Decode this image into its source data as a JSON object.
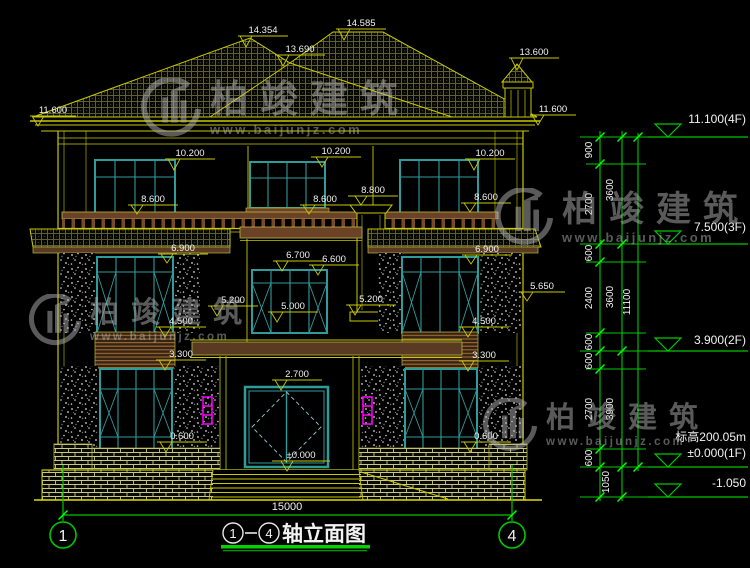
{
  "drawing": {
    "type": "elevation",
    "title": {
      "axis_from": "1",
      "axis_to": "4",
      "text": "轴立面图"
    },
    "bottom_dimension": {
      "label": "15000"
    },
    "axis_bubbles": [
      {
        "label": "1"
      },
      {
        "label": "4"
      }
    ]
  },
  "watermark": {
    "brand": "柏竣建筑",
    "url": "www.baijunjz.com",
    "logo": "baijun-building-logo"
  },
  "colors": {
    "background": "#000000",
    "cad_yellow": "#c9c900",
    "cad_green": "#00c800",
    "tick_green": "#00ff00",
    "window_teal": "#2f9b9b",
    "wood_brown": "#6b4226",
    "lamp_magenta": "#ff00ff",
    "text_white": "#f2f2f2",
    "watermark_gray": "#b4b4b4"
  },
  "elevation_markers": [
    {
      "t": "14.354",
      "x": 263,
      "y": 33,
      "l": [
        238,
        288,
        36
      ],
      "p": [
        246,
        47
      ]
    },
    {
      "t": "14.585",
      "x": 361,
      "y": 26,
      "l": [
        336,
        386,
        29
      ],
      "p": [
        344,
        40
      ]
    },
    {
      "t": "13.690",
      "x": 300,
      "y": 52,
      "l": [
        275,
        325,
        55
      ],
      "p": [
        283,
        66
      ]
    },
    {
      "t": "13.600",
      "x": 534,
      "y": 55,
      "l": [
        509,
        559,
        58
      ],
      "p": [
        517,
        70
      ]
    },
    {
      "t": "11.600",
      "x": 53,
      "y": 113,
      "l": [
        30,
        76,
        116
      ],
      "p": [
        38,
        126
      ]
    },
    {
      "t": "11.600",
      "x": 553,
      "y": 112,
      "l": [
        530,
        576,
        115
      ],
      "p": [
        538,
        125
      ]
    },
    {
      "t": "10.200",
      "x": 190,
      "y": 156,
      "l": [
        165,
        215,
        159
      ],
      "p": [
        174,
        170
      ]
    },
    {
      "t": "10.200",
      "x": 336,
      "y": 154,
      "l": [
        311,
        361,
        157
      ],
      "p": [
        322,
        167
      ]
    },
    {
      "t": "10.200",
      "x": 490,
      "y": 156,
      "l": [
        465,
        515,
        159
      ],
      "p": [
        474,
        170
      ]
    },
    {
      "t": "8.800",
      "x": 373,
      "y": 193,
      "l": [
        348,
        398,
        196
      ],
      "p": [
        361,
        205
      ]
    },
    {
      "t": "8.600",
      "x": 153,
      "y": 202,
      "l": [
        128,
        178,
        205
      ],
      "p": [
        137,
        214
      ]
    },
    {
      "t": "8.600",
      "x": 325,
      "y": 202,
      "l": [
        300,
        350,
        205
      ],
      "p": [
        309,
        214
      ]
    },
    {
      "t": "8.600",
      "x": 486,
      "y": 200,
      "l": [
        461,
        511,
        203
      ],
      "p": [
        470,
        212
      ]
    },
    {
      "t": "6.900",
      "x": 183,
      "y": 251,
      "l": [
        158,
        208,
        254
      ],
      "p": [
        167,
        263
      ]
    },
    {
      "t": "6.900",
      "x": 487,
      "y": 252,
      "l": [
        462,
        512,
        255
      ],
      "p": [
        471,
        264
      ]
    },
    {
      "t": "6.700",
      "x": 298,
      "y": 258,
      "l": [
        273,
        323,
        261
      ],
      "p": [
        282,
        271
      ]
    },
    {
      "t": "6.600",
      "x": 334,
      "y": 262,
      "l": [
        309,
        359,
        265
      ],
      "p": [
        318,
        275
      ]
    },
    {
      "t": "5.650",
      "x": 542,
      "y": 289,
      "l": [
        519,
        565,
        292
      ],
      "p": [
        527,
        301
      ]
    },
    {
      "t": "5.200",
      "x": 233,
      "y": 303,
      "l": [
        208,
        258,
        306
      ],
      "p": [
        217,
        316
      ]
    },
    {
      "t": "5.200",
      "x": 371,
      "y": 302,
      "l": [
        346,
        396,
        305
      ],
      "p": [
        355,
        315
      ]
    },
    {
      "t": "5.000",
      "x": 293,
      "y": 309,
      "l": [
        268,
        318,
        312
      ],
      "p": [
        277,
        322
      ]
    },
    {
      "t": "4.500",
      "x": 181,
      "y": 324,
      "l": [
        156,
        206,
        327
      ],
      "p": [
        165,
        337
      ]
    },
    {
      "t": "4.500",
      "x": 484,
      "y": 324,
      "l": [
        459,
        509,
        327
      ],
      "p": [
        468,
        337
      ]
    },
    {
      "t": "3.300",
      "x": 181,
      "y": 357,
      "l": [
        156,
        206,
        360
      ],
      "p": [
        165,
        370
      ]
    },
    {
      "t": "3.300",
      "x": 484,
      "y": 358,
      "l": [
        459,
        509,
        361
      ],
      "p": [
        468,
        371
      ]
    },
    {
      "t": "2.700",
      "x": 297,
      "y": 377,
      "l": [
        272,
        322,
        380
      ],
      "p": [
        281,
        390
      ]
    },
    {
      "t": "0.600",
      "x": 182,
      "y": 439,
      "l": [
        157,
        207,
        442
      ],
      "p": [
        166,
        452
      ]
    },
    {
      "t": "0.600",
      "x": 486,
      "y": 439,
      "l": [
        461,
        511,
        442
      ],
      "p": [
        470,
        452
      ]
    },
    {
      "t": "±0.000",
      "x": 301,
      "y": 458,
      "l": [
        272,
        330,
        461
      ],
      "p": [
        287,
        471
      ]
    }
  ],
  "level_markers": [
    {
      "t": "11.100(4F)",
      "y": 137,
      "ty": 123
    },
    {
      "t": "7.500(3F)",
      "y": 244,
      "ty": 231
    },
    {
      "t": "3.900(2F)",
      "y": 351,
      "ty": 344
    },
    {
      "t": "标高200.05m",
      "t2": "±0.000(1F)",
      "y": 467,
      "ty": 441,
      "ty2": 457
    },
    {
      "t": "-1.050",
      "y": 497,
      "ty": 487
    }
  ],
  "dim_chain": {
    "lines": [
      {
        "x": 600,
        "y1": 131,
        "y2": 501
      },
      {
        "x": 622,
        "y1": 131,
        "y2": 501
      },
      {
        "x": 638,
        "y1": 133,
        "y2": 471
      }
    ],
    "labels": [
      {
        "t": "900",
        "x": 592,
        "y": 150
      },
      {
        "t": "2700",
        "x": 592,
        "y": 204
      },
      {
        "t": "600",
        "x": 592,
        "y": 253
      },
      {
        "t": "2400",
        "x": 592,
        "y": 298
      },
      {
        "t": "600",
        "x": 592,
        "y": 342
      },
      {
        "t": "600",
        "x": 592,
        "y": 361
      },
      {
        "t": "2700",
        "x": 592,
        "y": 409
      },
      {
        "t": "600",
        "x": 592,
        "y": 458
      },
      {
        "t": "1050",
        "x": 609,
        "y": 482
      },
      {
        "t": "3600",
        "x": 613,
        "y": 190
      },
      {
        "t": "3600",
        "x": 613,
        "y": 297
      },
      {
        "t": "3900",
        "x": 613,
        "y": 409
      },
      {
        "t": "11100",
        "x": 630,
        "y": 302
      }
    ],
    "ticks": [
      {
        "x": 600,
        "y": 137
      },
      {
        "x": 600,
        "y": 164
      },
      {
        "x": 600,
        "y": 244
      },
      {
        "x": 600,
        "y": 262
      },
      {
        "x": 600,
        "y": 333
      },
      {
        "x": 600,
        "y": 351
      },
      {
        "x": 600,
        "y": 369
      },
      {
        "x": 600,
        "y": 449
      },
      {
        "x": 600,
        "y": 467
      },
      {
        "x": 600,
        "y": 497
      },
      {
        "x": 622,
        "y": 137
      },
      {
        "x": 622,
        "y": 244
      },
      {
        "x": 622,
        "y": 351
      },
      {
        "x": 622,
        "y": 467
      },
      {
        "x": 622,
        "y": 497
      },
      {
        "x": 638,
        "y": 137
      },
      {
        "x": 638,
        "y": 467
      },
      {
        "x": 63,
        "y": 515
      },
      {
        "x": 512,
        "y": 515
      }
    ],
    "connectors_minor": [
      164,
      262,
      333,
      369,
      449
    ],
    "connectors_major": [
      137,
      244,
      351,
      467,
      497
    ]
  }
}
